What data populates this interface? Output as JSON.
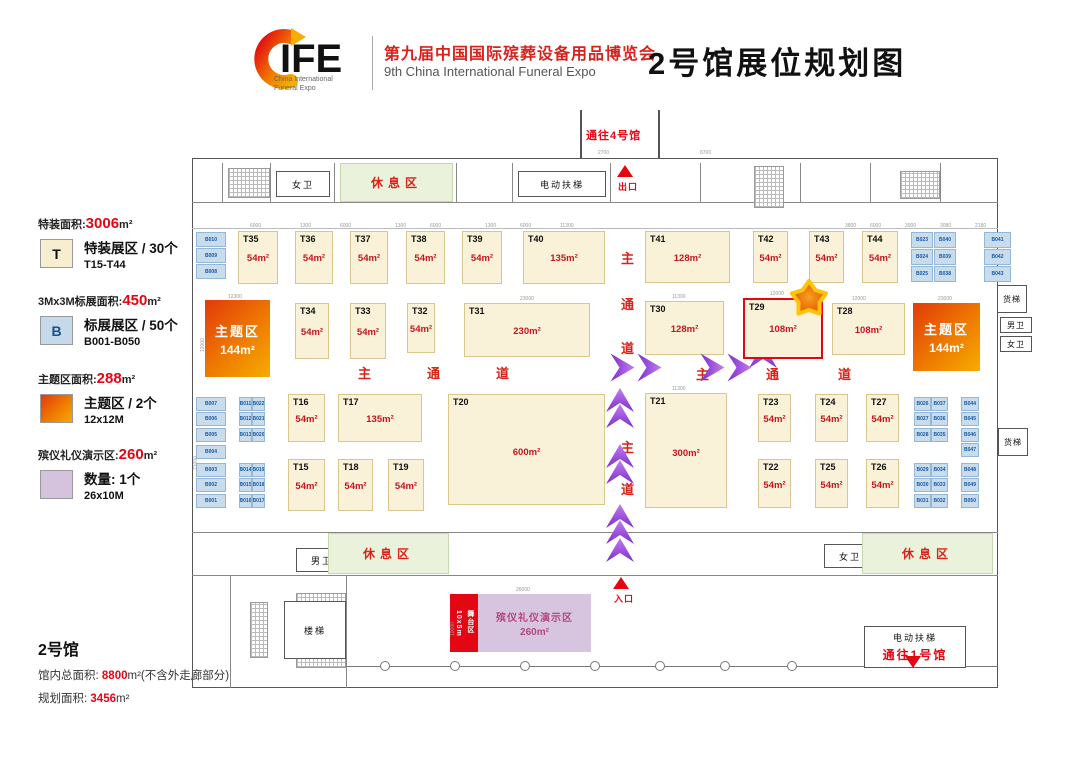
{
  "header": {
    "logo_text": "IFE",
    "logo_caption1": "China International",
    "logo_caption2": "Funeral Expo",
    "title_cn": "第九届中国国际殡葬设备用品博览会",
    "title_en": "9th China International Funeral Expo",
    "page_title": "2号馆展位规划图"
  },
  "legend": [
    {
      "t1": "特装面积:",
      "n": "3006",
      "t2": "m²",
      "sw": "T",
      "type": "t",
      "l1": "特装展区 / 30个",
      "l2": "T15-T44"
    },
    {
      "t1": "3Mx3M标展面积:",
      "n": "450",
      "t2": "m²",
      "sw": "B",
      "type": "b",
      "l1": "标展展区 / 50个",
      "l2": "B001-B050"
    },
    {
      "t1": "主题区面积:",
      "n": "288",
      "t2": "m²",
      "sw": "",
      "type": "theme",
      "l1": "主题区 / 2个",
      "l2": "12x12M"
    },
    {
      "t1": "殡仪礼仪演示区:",
      "n": "260",
      "t2": "m²",
      "sw": "",
      "type": "demo",
      "l1": "数量: 1个",
      "l2": "26x10M"
    }
  ],
  "hall_info": {
    "name": "2号馆",
    "l1a": "馆内总面积:",
    "l1n": "8800",
    "l1b": "m²(不含外走廊部分)",
    "l2a": "规划面积:",
    "l2n": "3456",
    "l2b": "m²"
  },
  "plan": {
    "labels": {
      "to_hall4": "通往4号馆",
      "to_hall1": "通往1号馆",
      "exit": "出口",
      "entrance": "入口",
      "escalator": "电动扶梯",
      "rest": "休息区",
      "stairs": "楼梯",
      "freight": "货梯",
      "mens": "男卫",
      "womens": "女卫",
      "stage_l1": "舞台区",
      "stage_l2": "10x5m",
      "demo_l1": "殡仪礼仪演示区",
      "demo_area": "260m²",
      "theme": "主题区",
      "theme_area": "144m²"
    },
    "booths_t": [
      {
        "id": "T35",
        "a": "54m²",
        "x": 238,
        "y": 231,
        "w": 40,
        "h": 53
      },
      {
        "id": "T36",
        "a": "54m²",
        "x": 295,
        "y": 231,
        "w": 38,
        "h": 53
      },
      {
        "id": "T37",
        "a": "54m²",
        "x": 350,
        "y": 231,
        "w": 38,
        "h": 53
      },
      {
        "id": "T38",
        "a": "54m²",
        "x": 406,
        "y": 231,
        "w": 39,
        "h": 53
      },
      {
        "id": "T39",
        "a": "54m²",
        "x": 462,
        "y": 231,
        "w": 40,
        "h": 53
      },
      {
        "id": "T40",
        "a": "135m²",
        "x": 523,
        "y": 231,
        "w": 82,
        "h": 53
      },
      {
        "id": "T41",
        "a": "128m²",
        "x": 645,
        "y": 231,
        "w": 85,
        "h": 52
      },
      {
        "id": "T42",
        "a": "54m²",
        "x": 753,
        "y": 231,
        "w": 35,
        "h": 52
      },
      {
        "id": "T43",
        "a": "54m²",
        "x": 809,
        "y": 231,
        "w": 35,
        "h": 52
      },
      {
        "id": "T44",
        "a": "54m²",
        "x": 862,
        "y": 231,
        "w": 36,
        "h": 52
      },
      {
        "id": "T34",
        "a": "54m²",
        "x": 295,
        "y": 303,
        "w": 34,
        "h": 56
      },
      {
        "id": "T33",
        "a": "54m²",
        "x": 350,
        "y": 303,
        "w": 36,
        "h": 56
      },
      {
        "id": "T32",
        "a": "54m²",
        "x": 407,
        "y": 303,
        "w": 28,
        "h": 50
      },
      {
        "id": "T31",
        "a": "230m²",
        "x": 464,
        "y": 303,
        "w": 126,
        "h": 54
      },
      {
        "id": "T30",
        "a": "128m²",
        "x": 645,
        "y": 301,
        "w": 79,
        "h": 54
      },
      {
        "id": "T29",
        "a": "108m²",
        "x": 743,
        "y": 298,
        "w": 80,
        "h": 61,
        "hl": true
      },
      {
        "id": "T28",
        "a": "108m²",
        "x": 832,
        "y": 303,
        "w": 73,
        "h": 52
      },
      {
        "id": "T16",
        "a": "54m²",
        "x": 288,
        "y": 394,
        "w": 37,
        "h": 48
      },
      {
        "id": "T17",
        "a": "135m²",
        "x": 338,
        "y": 394,
        "w": 84,
        "h": 48
      },
      {
        "id": "T20",
        "a": "600m²",
        "x": 448,
        "y": 394,
        "w": 157,
        "h": 111
      },
      {
        "id": "T21",
        "a": "300m²",
        "x": 645,
        "y": 393,
        "w": 82,
        "h": 115
      },
      {
        "id": "T23",
        "a": "54m²",
        "x": 758,
        "y": 394,
        "w": 33,
        "h": 48
      },
      {
        "id": "T24",
        "a": "54m²",
        "x": 815,
        "y": 394,
        "w": 33,
        "h": 48
      },
      {
        "id": "T27",
        "a": "54m²",
        "x": 866,
        "y": 394,
        "w": 33,
        "h": 48
      },
      {
        "id": "T15",
        "a": "54m²",
        "x": 288,
        "y": 459,
        "w": 37,
        "h": 52
      },
      {
        "id": "T18",
        "a": "54m²",
        "x": 338,
        "y": 459,
        "w": 35,
        "h": 52
      },
      {
        "id": "T19",
        "a": "54m²",
        "x": 388,
        "y": 459,
        "w": 36,
        "h": 52
      },
      {
        "id": "T22",
        "a": "54m²",
        "x": 758,
        "y": 459,
        "w": 33,
        "h": 49
      },
      {
        "id": "T25",
        "a": "54m²",
        "x": 815,
        "y": 459,
        "w": 33,
        "h": 49
      },
      {
        "id": "T26",
        "a": "54m²",
        "x": 866,
        "y": 459,
        "w": 33,
        "h": 49
      }
    ],
    "booths_b": [
      {
        "l": "B010",
        "x": 196,
        "y": 232,
        "w": 30,
        "h": 15
      },
      {
        "l": "B009",
        "x": 196,
        "y": 248,
        "w": 30,
        "h": 15
      },
      {
        "l": "B008",
        "x": 196,
        "y": 264,
        "w": 30,
        "h": 15
      },
      {
        "l": "B007",
        "x": 196,
        "y": 397,
        "w": 30,
        "h": 14
      },
      {
        "l": "B006",
        "x": 196,
        "y": 412,
        "w": 30,
        "h": 14
      },
      {
        "l": "B005",
        "x": 196,
        "y": 428,
        "w": 30,
        "h": 14
      },
      {
        "l": "B004",
        "x": 196,
        "y": 445,
        "w": 30,
        "h": 14
      },
      {
        "l": "B003",
        "x": 196,
        "y": 463,
        "w": 30,
        "h": 14
      },
      {
        "l": "B002",
        "x": 196,
        "y": 478,
        "w": 30,
        "h": 14
      },
      {
        "l": "B001",
        "x": 196,
        "y": 494,
        "w": 30,
        "h": 14
      },
      {
        "l": "B011",
        "x": 239,
        "y": 397,
        "w": 13,
        "h": 14
      },
      {
        "l": "B022",
        "x": 252,
        "y": 397,
        "w": 13,
        "h": 14
      },
      {
        "l": "B012",
        "x": 239,
        "y": 412,
        "w": 13,
        "h": 14
      },
      {
        "l": "B021",
        "x": 252,
        "y": 412,
        "w": 13,
        "h": 14
      },
      {
        "l": "B013",
        "x": 239,
        "y": 428,
        "w": 13,
        "h": 14
      },
      {
        "l": "B020",
        "x": 252,
        "y": 428,
        "w": 13,
        "h": 14
      },
      {
        "l": "B014",
        "x": 239,
        "y": 463,
        "w": 13,
        "h": 14
      },
      {
        "l": "B019",
        "x": 252,
        "y": 463,
        "w": 13,
        "h": 14
      },
      {
        "l": "B015",
        "x": 239,
        "y": 478,
        "w": 13,
        "h": 14
      },
      {
        "l": "B018",
        "x": 252,
        "y": 478,
        "w": 13,
        "h": 14
      },
      {
        "l": "B016",
        "x": 239,
        "y": 494,
        "w": 13,
        "h": 14
      },
      {
        "l": "B017",
        "x": 252,
        "y": 494,
        "w": 13,
        "h": 14
      },
      {
        "l": "B023",
        "x": 911,
        "y": 232,
        "w": 22,
        "h": 16
      },
      {
        "l": "B040",
        "x": 934,
        "y": 232,
        "w": 22,
        "h": 16
      },
      {
        "l": "B024",
        "x": 911,
        "y": 249,
        "w": 22,
        "h": 16
      },
      {
        "l": "B039",
        "x": 934,
        "y": 249,
        "w": 22,
        "h": 16
      },
      {
        "l": "B025",
        "x": 911,
        "y": 266,
        "w": 22,
        "h": 16
      },
      {
        "l": "B038",
        "x": 934,
        "y": 266,
        "w": 22,
        "h": 16
      },
      {
        "l": "B041",
        "x": 984,
        "y": 232,
        "w": 27,
        "h": 16
      },
      {
        "l": "B042",
        "x": 984,
        "y": 249,
        "w": 27,
        "h": 16
      },
      {
        "l": "B043",
        "x": 984,
        "y": 266,
        "w": 27,
        "h": 16
      },
      {
        "l": "B026",
        "x": 914,
        "y": 397,
        "w": 17,
        "h": 14
      },
      {
        "l": "B037",
        "x": 931,
        "y": 397,
        "w": 17,
        "h": 14
      },
      {
        "l": "B027",
        "x": 914,
        "y": 412,
        "w": 17,
        "h": 14
      },
      {
        "l": "B036",
        "x": 931,
        "y": 412,
        "w": 17,
        "h": 14
      },
      {
        "l": "B028",
        "x": 914,
        "y": 428,
        "w": 17,
        "h": 14
      },
      {
        "l": "B035",
        "x": 931,
        "y": 428,
        "w": 17,
        "h": 14
      },
      {
        "l": "B029",
        "x": 914,
        "y": 463,
        "w": 17,
        "h": 14
      },
      {
        "l": "B034",
        "x": 931,
        "y": 463,
        "w": 17,
        "h": 14
      },
      {
        "l": "B030",
        "x": 914,
        "y": 478,
        "w": 17,
        "h": 14
      },
      {
        "l": "B033",
        "x": 931,
        "y": 478,
        "w": 17,
        "h": 14
      },
      {
        "l": "B031",
        "x": 914,
        "y": 494,
        "w": 17,
        "h": 14
      },
      {
        "l": "B032",
        "x": 931,
        "y": 494,
        "w": 17,
        "h": 14
      },
      {
        "l": "B044",
        "x": 961,
        "y": 397,
        "w": 18,
        "h": 14
      },
      {
        "l": "B045",
        "x": 961,
        "y": 412,
        "w": 18,
        "h": 14
      },
      {
        "l": "B046",
        "x": 961,
        "y": 428,
        "w": 18,
        "h": 14
      },
      {
        "l": "B047",
        "x": 961,
        "y": 443,
        "w": 18,
        "h": 14
      },
      {
        "l": "B048",
        "x": 961,
        "y": 463,
        "w": 18,
        "h": 14
      },
      {
        "l": "B049",
        "x": 961,
        "y": 478,
        "w": 18,
        "h": 14
      },
      {
        "l": "B050",
        "x": 961,
        "y": 494,
        "w": 18,
        "h": 14
      }
    ],
    "theme_zones": [
      {
        "x": 205,
        "y": 300,
        "w": 65,
        "h": 77
      },
      {
        "x": 913,
        "y": 303,
        "w": 67,
        "h": 68
      }
    ],
    "facilities": [
      {
        "label": "女卫",
        "x": 276,
        "y": 171,
        "w": 54,
        "h": 26,
        "style": "fac"
      },
      {
        "label": "休息区",
        "x": 340,
        "y": 163,
        "w": 113,
        "h": 39,
        "style": "rest"
      },
      {
        "label": "电动扶梯",
        "x": 518,
        "y": 171,
        "w": 88,
        "h": 26,
        "style": "fac"
      },
      {
        "label": "男卫",
        "x": 296,
        "y": 548,
        "w": 52,
        "h": 24,
        "style": "fac"
      },
      {
        "label": "休息区",
        "x": 328,
        "y": 533,
        "w": 121,
        "h": 41,
        "style": "rest"
      },
      {
        "label": "女卫",
        "x": 824,
        "y": 544,
        "w": 52,
        "h": 24,
        "style": "fac"
      },
      {
        "label": "休息区",
        "x": 862,
        "y": 533,
        "w": 131,
        "h": 41,
        "style": "rest"
      },
      {
        "label": "楼梯",
        "x": 284,
        "y": 601,
        "w": 62,
        "h": 58,
        "style": "fac"
      },
      {
        "label": "货梯",
        "x": 997,
        "y": 285,
        "w": 30,
        "h": 28,
        "style": "fac small"
      },
      {
        "label": "男卫",
        "x": 1000,
        "y": 317,
        "w": 32,
        "h": 16,
        "style": "fac small"
      },
      {
        "label": "女卫",
        "x": 1000,
        "y": 336,
        "w": 32,
        "h": 16,
        "style": "fac small"
      },
      {
        "label": "货梯",
        "x": 998,
        "y": 428,
        "w": 30,
        "h": 28,
        "style": "fac small"
      }
    ],
    "corridor_chars": [
      {
        "c": "主",
        "x": 358,
        "y": 363
      },
      {
        "c": "通",
        "x": 427,
        "y": 363
      },
      {
        "c": "道",
        "x": 496,
        "y": 363
      },
      {
        "c": "主",
        "x": 696,
        "y": 364
      },
      {
        "c": "通",
        "x": 766,
        "y": 364
      },
      {
        "c": "道",
        "x": 838,
        "y": 364
      },
      {
        "c": "主",
        "x": 621,
        "y": 248
      },
      {
        "c": "通",
        "x": 621,
        "y": 294
      },
      {
        "c": "道",
        "x": 621,
        "y": 338
      },
      {
        "c": "主",
        "x": 621,
        "y": 437
      },
      {
        "c": "道",
        "x": 621,
        "y": 479
      }
    ],
    "arrows": {
      "right": [
        {
          "x": 604,
          "y": 352
        },
        {
          "x": 631,
          "y": 352
        },
        {
          "x": 694,
          "y": 352
        },
        {
          "x": 721,
          "y": 352
        }
      ],
      "up": [
        {
          "x": 748,
          "y": 344
        },
        {
          "x": 605,
          "y": 388
        },
        {
          "x": 605,
          "y": 404
        },
        {
          "x": 605,
          "y": 444
        },
        {
          "x": 605,
          "y": 460
        },
        {
          "x": 605,
          "y": 504
        },
        {
          "x": 605,
          "y": 520
        },
        {
          "x": 605,
          "y": 538
        }
      ]
    },
    "dims": [
      {
        "t": "2700",
        "x": 598,
        "y": 150
      },
      {
        "t": "8700",
        "x": 700,
        "y": 150
      },
      {
        "t": "6000",
        "x": 250,
        "y": 223
      },
      {
        "t": "1300",
        "x": 300,
        "y": 223
      },
      {
        "t": "6000",
        "x": 340,
        "y": 223
      },
      {
        "t": "1300",
        "x": 395,
        "y": 223
      },
      {
        "t": "6000",
        "x": 430,
        "y": 223
      },
      {
        "t": "1300",
        "x": 485,
        "y": 223
      },
      {
        "t": "6000",
        "x": 520,
        "y": 223
      },
      {
        "t": "11300",
        "x": 560,
        "y": 223
      },
      {
        "t": "3800",
        "x": 845,
        "y": 223
      },
      {
        "t": "6000",
        "x": 870,
        "y": 223
      },
      {
        "t": "3000",
        "x": 905,
        "y": 223
      },
      {
        "t": "3080",
        "x": 940,
        "y": 223
      },
      {
        "t": "2180",
        "x": 975,
        "y": 223
      },
      {
        "t": "12300",
        "x": 228,
        "y": 294
      },
      {
        "t": "23000",
        "x": 520,
        "y": 296
      },
      {
        "t": "11300",
        "x": 672,
        "y": 294
      },
      {
        "t": "12000",
        "x": 770,
        "y": 291
      },
      {
        "t": "12000",
        "x": 852,
        "y": 296
      },
      {
        "t": "23000",
        "x": 938,
        "y": 296
      },
      {
        "t": "11300",
        "x": 672,
        "y": 386
      },
      {
        "t": "26000",
        "x": 516,
        "y": 587
      },
      {
        "t": "12000",
        "x": 200,
        "y": 352,
        "r": 1
      },
      {
        "t": "21000",
        "x": 193,
        "y": 470,
        "r": 1
      },
      {
        "t": "10000",
        "x": 450,
        "y": 636,
        "r": 1
      }
    ]
  }
}
